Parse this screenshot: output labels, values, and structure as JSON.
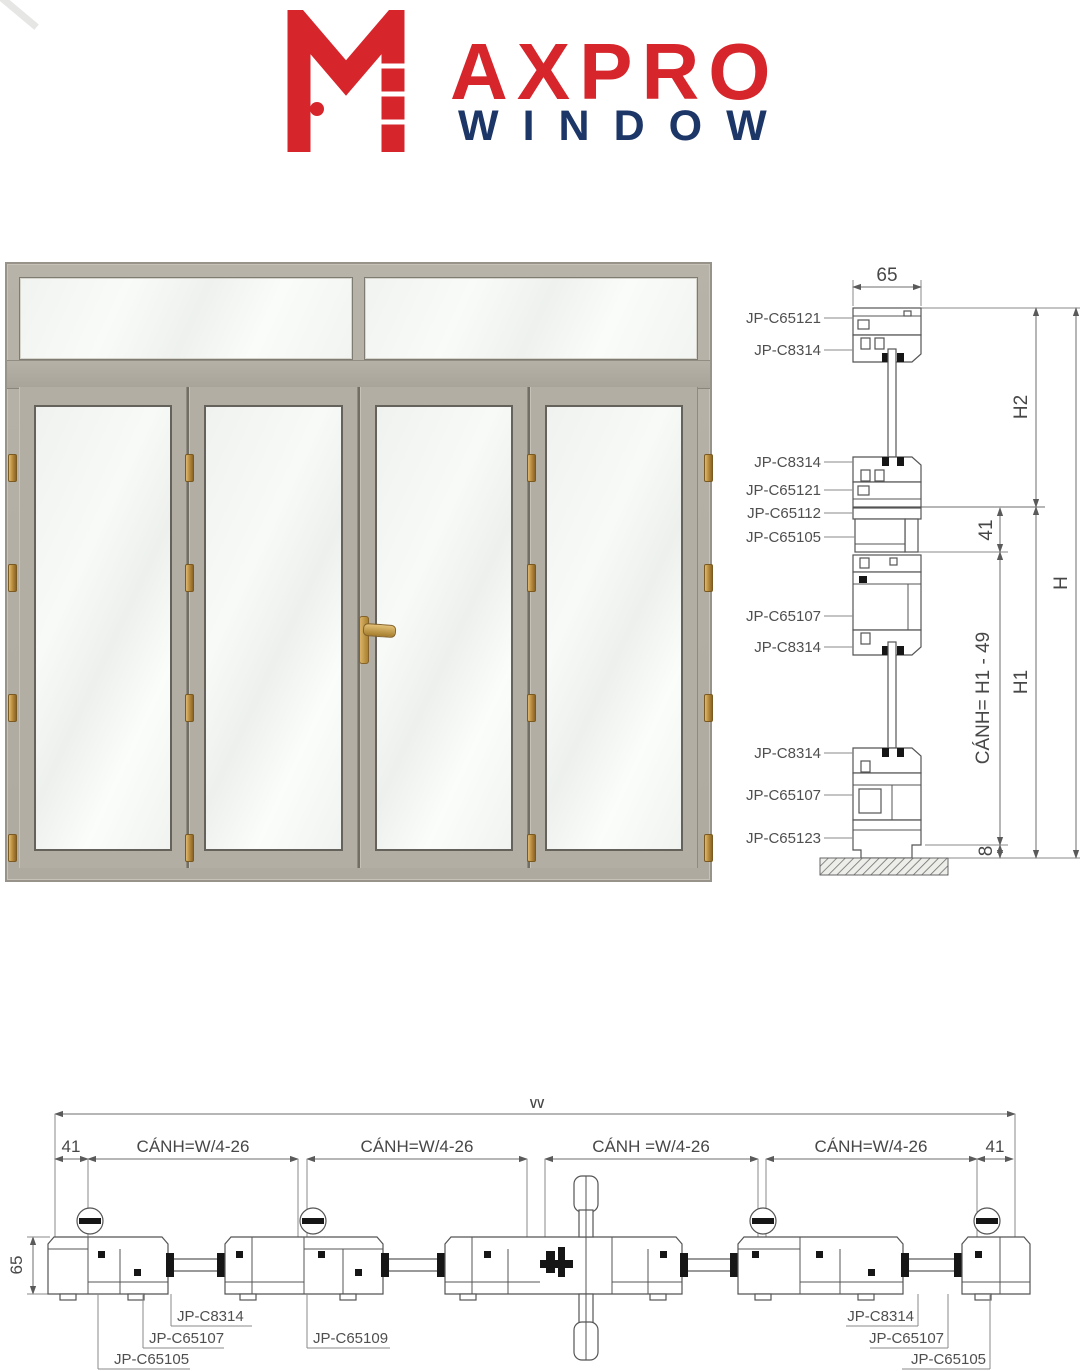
{
  "brand": {
    "wordmark_red": "AXPRO",
    "wordmark_blue": "WINDOW",
    "colors": {
      "red": "#d6252b",
      "navy": "#1c3668"
    }
  },
  "vertical_section": {
    "top_width": "65",
    "part_labels": [
      "JP-C65121",
      "JP-C8314",
      "JP-C8314",
      "JP-C65121",
      "JP-C65112",
      "JP-C65105",
      "JP-C65107",
      "JP-C8314",
      "JP-C8314",
      "JP-C65107",
      "JP-C65123"
    ],
    "dims": {
      "h2": "H2",
      "d41": "41",
      "h": "H",
      "sash_height": "CÁNH= H1 - 49",
      "h1": "H1",
      "d8": "8"
    }
  },
  "horizontal_section": {
    "total_width": "W",
    "left_margin": "41",
    "right_margin": "41",
    "leaf_dims": [
      "CÁNH=W/4-26",
      "CÁNH=W/4-26",
      "CÁNH =W/4-26",
      "CÁNH=W/4-26"
    ],
    "depth": "65",
    "left_part_labels": [
      "JP-C8314",
      "JP-C65107",
      "JP-C65105"
    ],
    "center_part_label": "JP-C65109",
    "right_part_labels": [
      "JP-C8314",
      "JP-C65107",
      "JP-C65105"
    ]
  }
}
